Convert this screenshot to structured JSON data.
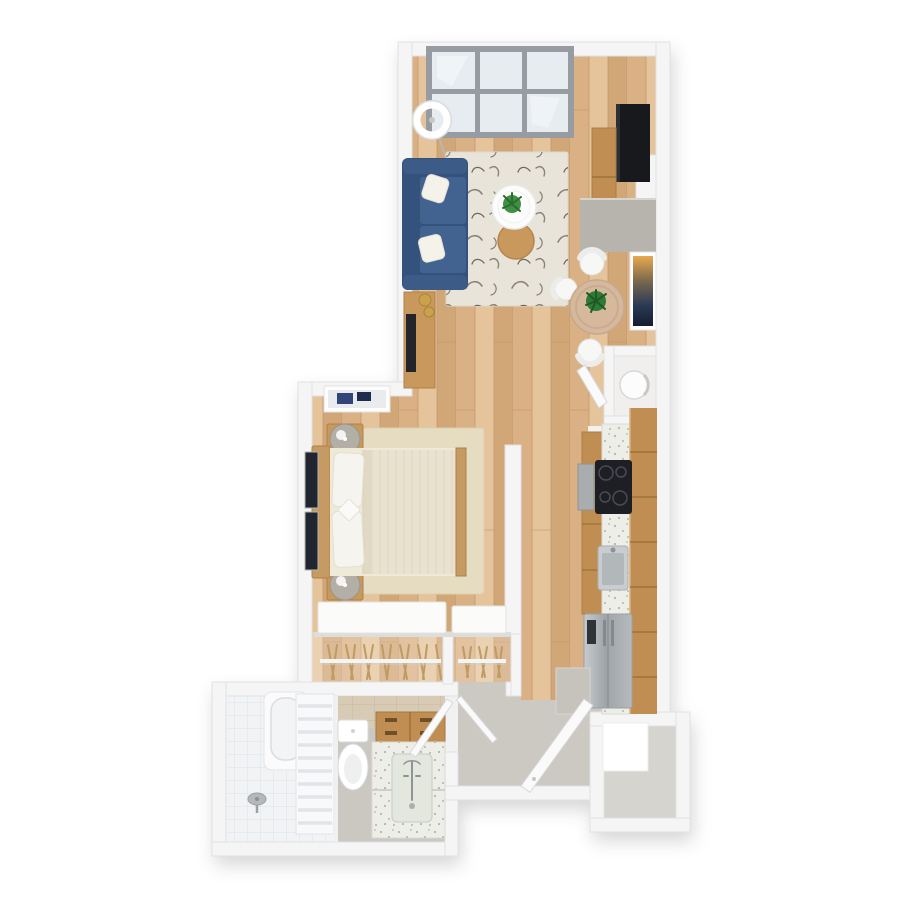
{
  "canvas": {
    "width": 900,
    "height": 900,
    "background": "#ffffff",
    "description": "Top-down 3D rendered floor plan of a studio apartment, no visible text labels"
  },
  "colors": {
    "wall": "#f5f5f6",
    "wallEdge": "#e1e1e3",
    "wood1": "#dab184",
    "wood2": "#e5c49c",
    "wood3": "#d1a778",
    "woodLine": "#c09467",
    "rugLiving": "#e9e4da",
    "feather": "#8b8379",
    "rugBedroom": "#e6dcc2",
    "sofa": "#3c5b86",
    "sofaDark": "#33527c",
    "sofaSeat": "#426390",
    "pillow": "#f5f2ea",
    "tableWhite": "#fcfcfc",
    "tableWood": "#c8985d",
    "plant": "#3e9144",
    "plantDark": "#2b6c31",
    "diningTable": "#d6b89c",
    "chair": "#f7f7f6",
    "tv": "#17191d",
    "cabWood": "#c08e52",
    "cabSeam": "#9c7239",
    "counter": "#edeee7",
    "speck": "#b4b8a6",
    "cooktop": "#1d1f24",
    "steel1": "#c7cbce",
    "steel2": "#9ea4a8",
    "steel3": "#b6babd",
    "grayConsole": "#b7b4ae",
    "bathFloor": "#cbc8c2",
    "hallFloor": "#ccc9c3",
    "showerTile": "#f1f3f5",
    "showerLine": "#dde2e7",
    "wallTile": "#d8cbb5",
    "wallTileLine": "#c6b89f",
    "door": "#fafafa",
    "doorEdge": "#d8d8da",
    "entryFloor": "#d6d4ce",
    "blanket": "#e9e2cf",
    "blanketLine": "#ded5bd",
    "headboard": "#c59a63",
    "artDark": "#21252f",
    "windowFrame": "#969ca1",
    "glass": "#e6ecf0",
    "lamp": "#b3afa7",
    "hanger": "#bf9a63",
    "gold": "#c9a24b"
  },
  "rooms": [
    {
      "id": "living-room",
      "furniture": [
        "six-pane-window",
        "arc-floor-lamp",
        "blue-sofa",
        "throw-pillows",
        "patterned-area-rug",
        "white-coffee-table",
        "wood-side-table",
        "potted-plant",
        "media-console",
        "wall-tv",
        "wood-cabinet",
        "gray-half-wall"
      ]
    },
    {
      "id": "dining-nook",
      "furniture": [
        "round-dining-table",
        "white-chairs",
        "table-plant",
        "abstract-wall-art"
      ]
    },
    {
      "id": "utility-closet",
      "furniture": [
        "water-heater-cylinder",
        "closet-door"
      ]
    },
    {
      "id": "kitchen",
      "furniture": [
        "base-cabinets",
        "speckled-countertop",
        "induction-cooktop",
        "oven",
        "steel-sink",
        "stainless-fridge",
        "tall-wood-cabinets",
        "gray-end-panel"
      ]
    },
    {
      "id": "bedroom",
      "furniture": [
        "double-bed",
        "wood-headboard",
        "white-pillows",
        "cream-blanket",
        "nightstands",
        "gray-table-lamps",
        "beige-area-rug",
        "framed-wall-art",
        "dark-leaning-frames",
        "partition-wall"
      ]
    },
    {
      "id": "closet",
      "furniture": [
        "sliding-doors",
        "hanging-rods",
        "wood-hangers"
      ]
    },
    {
      "id": "bathroom",
      "furniture": [
        "tiled-shower",
        "bathtub",
        "slatted-panel",
        "floor-drain",
        "toilet",
        "wood-vanity-drawers",
        "speckled-vanity-counter",
        "inset-sink",
        "faucet",
        "beige-tiled-wall",
        "bathroom-door"
      ]
    },
    {
      "id": "hallway",
      "furniture": [
        "entry-door",
        "hall-closet-door"
      ]
    },
    {
      "id": "entry-storage",
      "furniture": [
        "white-cabinet"
      ]
    }
  ]
}
